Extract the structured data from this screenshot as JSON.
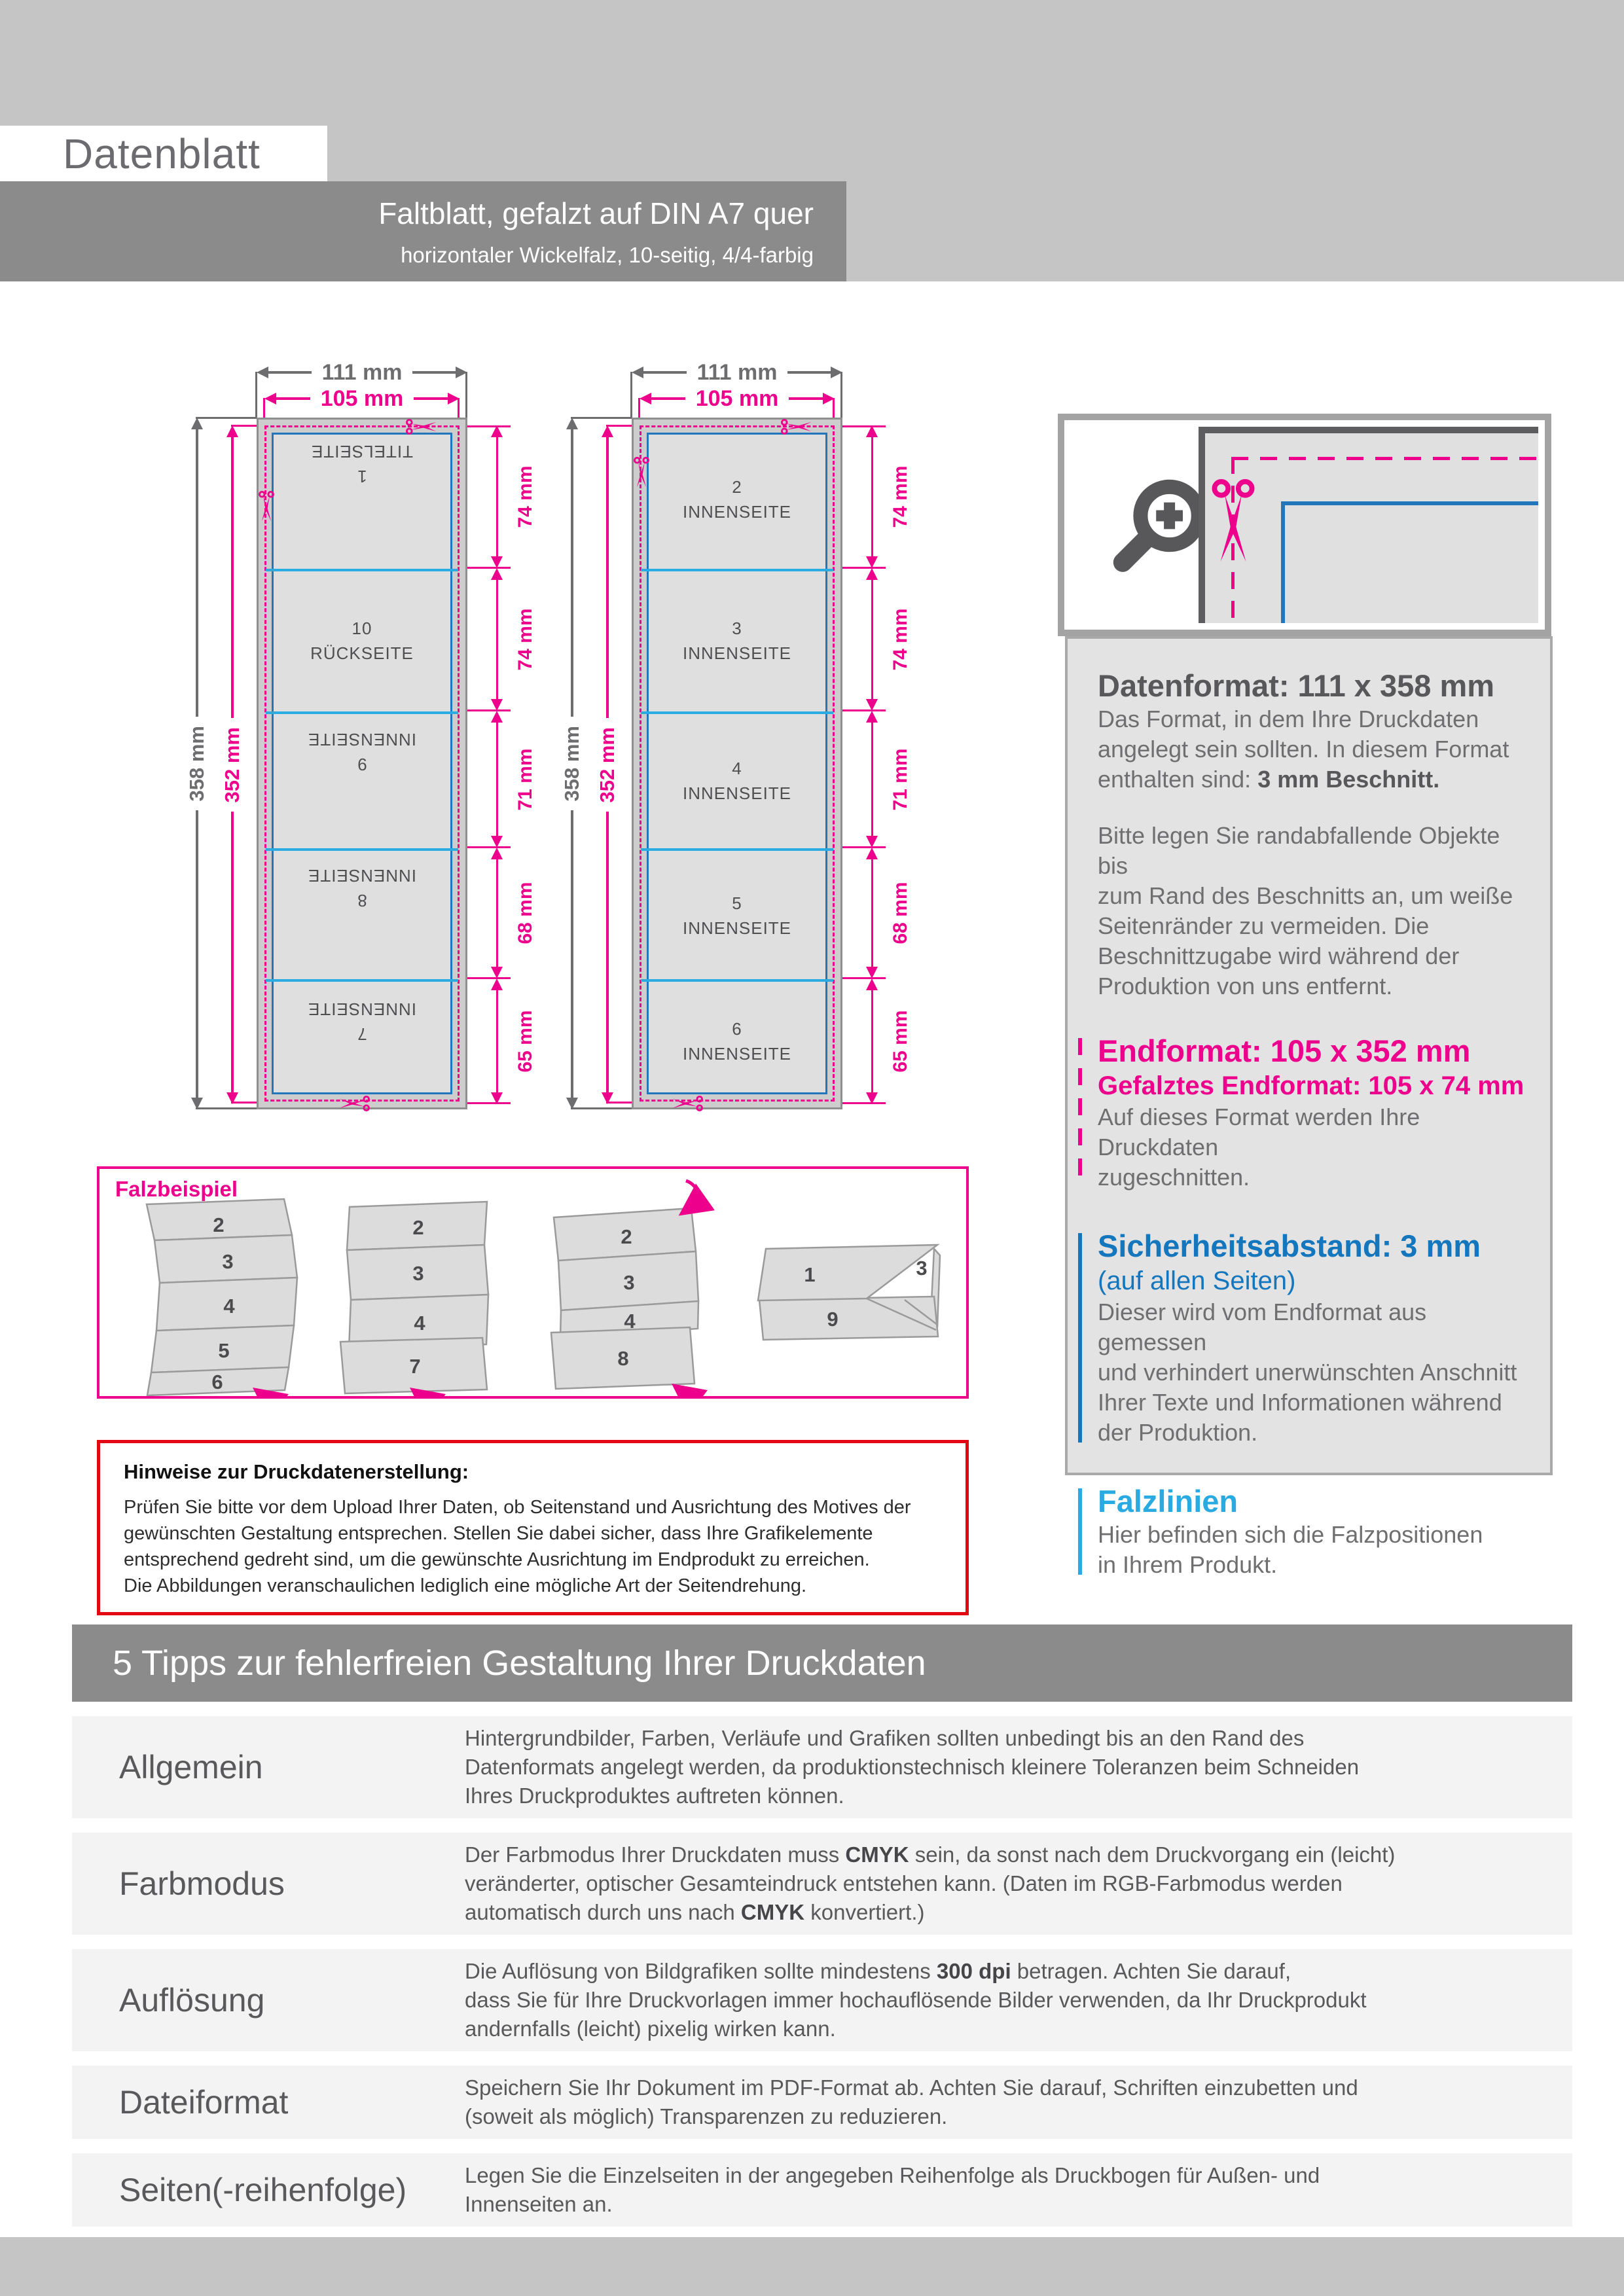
{
  "header": {
    "title": "Datenblatt",
    "bar_line1": "Faltblatt, gefalzt auf DIN A7 quer",
    "bar_line2": "horizontaler Wickelfalz, 10-seitig, 4/4-farbig"
  },
  "diagram": {
    "width_outer": "111 mm",
    "width_inner": "105 mm",
    "height_outer": "358 mm",
    "height_inner": "352 mm",
    "segments": [
      "74 mm",
      "74 mm",
      "71 mm",
      "68 mm",
      "65 mm"
    ],
    "panel1": [
      {
        "n": "1",
        "l": "TITELSEITE"
      },
      {
        "n": "10",
        "l": "RÜCKSEITE"
      },
      {
        "n": "9",
        "l": "INNENSEITE"
      },
      {
        "n": "8",
        "l": "INNENSEITE"
      },
      {
        "n": "7",
        "l": "INNENSEITE"
      }
    ],
    "panel2": [
      {
        "n": "2",
        "l": "INNENSEITE"
      },
      {
        "n": "3",
        "l": "INNENSEITE"
      },
      {
        "n": "4",
        "l": "INNENSEITE"
      },
      {
        "n": "5",
        "l": "INNENSEITE"
      },
      {
        "n": "6",
        "l": "INNENSEITE"
      }
    ]
  },
  "info": {
    "datenformat": {
      "title": "Datenformat: 111 x 358 mm",
      "p1l1": "Das Format, in dem Ihre Druckdaten",
      "p1l2": "angelegt sein sollten. In diesem Format",
      "p1l3_pre": "enthalten sind: ",
      "p1l3_bold": "3 mm Beschnitt.",
      "p2l1": "Bitte legen Sie randabfallende Objekte bis",
      "p2l2": "zum Rand des Beschnitts an, um weiße",
      "p2l3": "Seitenränder zu vermeiden. Die",
      "p2l4": "Beschnittzugabe wird während der",
      "p2l5": "Produktion von uns entfernt."
    },
    "endformat": {
      "title": "Endformat: 105 x 352 mm",
      "subtitle": "Gefalztes Endformat: 105 x 74 mm",
      "b1": "Auf dieses Format werden Ihre Druckdaten",
      "b2": "zugeschnitten."
    },
    "sicherheit": {
      "title": "Sicherheitsabstand: 3 mm",
      "subtitle": "(auf allen Seiten)",
      "b1": "Dieser wird vom Endformat aus gemessen",
      "b2": "und verhindert unerwünschten Anschnitt",
      "b3": "Ihrer Texte und Informationen während",
      "b4": "der Produktion."
    },
    "falzlinien": {
      "title": "Falzlinien",
      "b1": "Hier befinden sich die Falzpositionen",
      "b2": "in Ihrem Produkt."
    }
  },
  "falzbeispiel": {
    "title": "Falzbeispiel",
    "steps": [
      [
        "2",
        "3",
        "4",
        "5",
        "6"
      ],
      [
        "2",
        "3",
        "4",
        "7"
      ],
      [
        "2",
        "3",
        "4",
        "8"
      ],
      [
        "1",
        "9",
        "3"
      ]
    ]
  },
  "hinweise": {
    "title": "Hinweise zur Druckdatenerstellung:",
    "l1": "Prüfen Sie bitte vor dem Upload Ihrer Daten, ob Seitenstand und Ausrichtung des Motives der",
    "l2": "gewünschten Gestaltung entsprechen. Stellen Sie dabei sicher, dass Ihre Grafikelemente",
    "l3": "entsprechend gedreht sind, um die gewünschte Ausrichtung im Endprodukt zu erreichen.",
    "l4": "Die Abbildungen veranschaulichen lediglich eine mögliche Art der Seitendrehung."
  },
  "tips": {
    "title": "5 Tipps zur fehlerfreien Gestaltung Ihrer Druckdaten",
    "allgemein": {
      "label": "Allgemein",
      "l1": "Hintergrundbilder, Farben, Verläufe und Grafiken sollten unbedingt bis an den Rand des",
      "l2": "Datenformats angelegt werden, da produktionstechnisch kleinere Toleranzen beim Schneiden",
      "l3": "Ihres Druckproduktes auftreten können."
    },
    "farbmodus": {
      "label": "Farbmodus",
      "l1_pre": "Der Farbmodus Ihrer Druckdaten muss ",
      "l1_bold": "CMYK",
      "l1_post": " sein, da sonst nach dem Druckvorgang ein (leicht)",
      "l2": "veränderter, optischer Gesamteindruck entstehen kann. (Daten im RGB-Farbmodus werden",
      "l3_pre": "automatisch durch uns nach ",
      "l3_bold": "CMYK",
      "l3_post": " konvertiert.)"
    },
    "aufloesung": {
      "label": "Auflösung",
      "l1_pre": "Die Auflösung von Bildgrafiken sollte mindestens ",
      "l1_bold": "300 dpi",
      "l1_post": " betragen. Achten Sie darauf,",
      "l2": "dass Sie für Ihre Druckvorlagen immer hochauflösende Bilder verwenden, da Ihr Druckprodukt",
      "l3": "andernfalls (leicht) pixelig wirken kann."
    },
    "dateiformat": {
      "label": "Dateiformat",
      "l1": "Speichern Sie Ihr Dokument im PDF-Format ab. Achten Sie darauf, Schriften einzubetten und",
      "l2": "(soweit als möglich) Transparenzen zu reduzieren."
    },
    "seiten": {
      "label": "Seiten(-reihenfolge)",
      "l1": "Legen Sie die Einzelseiten in der angegeben Reihenfolge als Druckbogen für Außen- und",
      "l2": "Innenseiten an."
    }
  },
  "colors": {
    "magenta": "#ec008c",
    "blue": "#1476bc",
    "cyan": "#29abe2",
    "red": "#e30613",
    "bar_gray": "#8b8b8b",
    "light_gray": "#c6c5c5"
  }
}
